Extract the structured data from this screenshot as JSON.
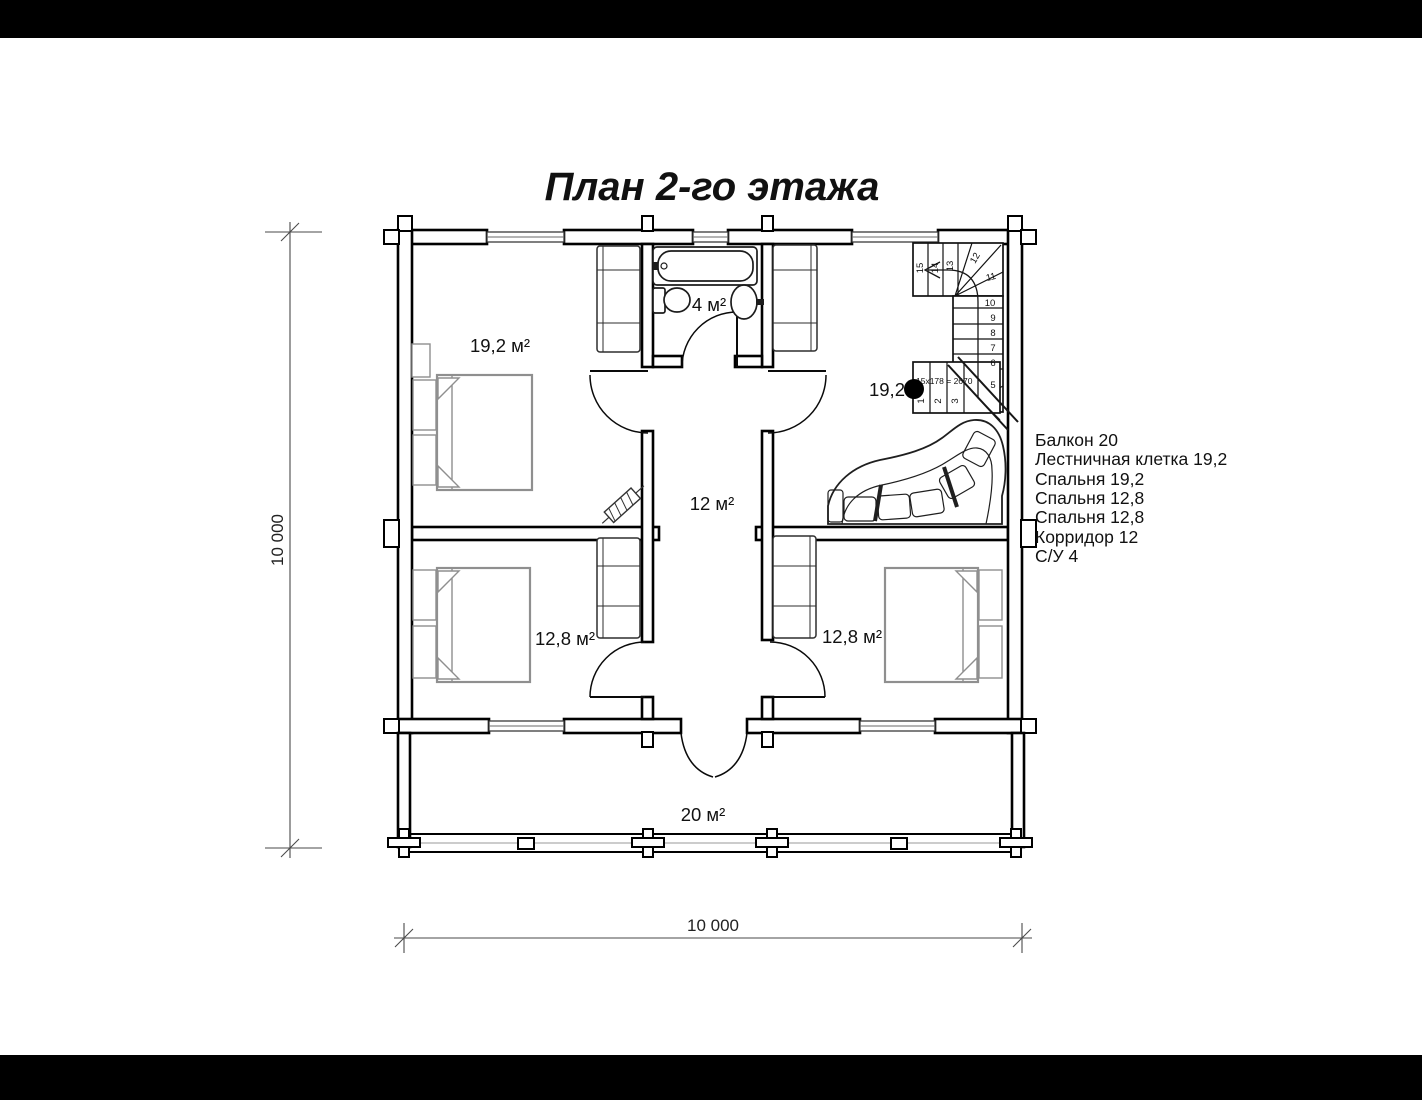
{
  "title": "План 2-го этажа",
  "labels": {
    "bedroom_top": "19,2 м²",
    "bathroom": "4 м²",
    "corridor": "12 м²",
    "bedroom_left": "12,8 м²",
    "bedroom_right": "12,8 м²",
    "balcony": "20 м²",
    "stairwell": "19,2",
    "stair_formula": "15x178 = 2670"
  },
  "stairs": {
    "numbers": [
      "1",
      "2",
      "3",
      "5",
      "6",
      "7",
      "8",
      "9",
      "10",
      "11",
      "12",
      "13",
      "14",
      "15"
    ]
  },
  "legend": {
    "items": [
      "Балкон 20",
      "Лестничная клетка 19,2",
      "Спальня 19,2",
      "Спальня 12,8",
      "Спальня 12,8",
      "Корридор 12",
      "С/У 4"
    ]
  },
  "dimensions": {
    "horizontal": "10 000",
    "vertical": "10 000"
  },
  "colors": {
    "ink": "#000000",
    "furniture_gray": "#8f8f8f",
    "background": "#ffffff",
    "letterbox": "#000000"
  }
}
